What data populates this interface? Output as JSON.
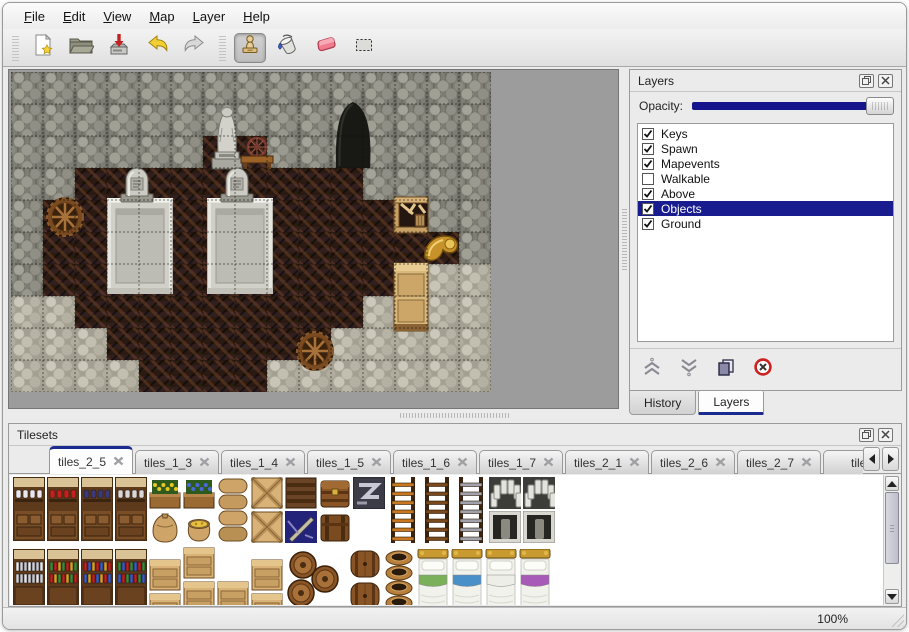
{
  "menu": {
    "items": [
      {
        "label": "File"
      },
      {
        "label": "Edit"
      },
      {
        "label": "View"
      },
      {
        "label": "Map"
      },
      {
        "label": "Layer"
      },
      {
        "label": "Help"
      }
    ]
  },
  "toolbar": {
    "groups": [
      {
        "buttons": [
          {
            "name": "new-file",
            "icon": "new-file-icon",
            "selected": false
          },
          {
            "name": "open",
            "icon": "open-icon",
            "selected": false
          },
          {
            "name": "save",
            "icon": "save-icon",
            "selected": false
          },
          {
            "name": "undo",
            "icon": "undo-icon",
            "selected": false
          },
          {
            "name": "redo",
            "icon": "redo-icon",
            "selected": false
          }
        ]
      },
      {
        "buttons": [
          {
            "name": "stamp-tool",
            "icon": "stamp-icon",
            "selected": true
          },
          {
            "name": "fill-tool",
            "icon": "fill-icon",
            "selected": false
          },
          {
            "name": "eraser-tool",
            "icon": "eraser-icon",
            "selected": false
          },
          {
            "name": "select-tool",
            "icon": "select-icon",
            "selected": false
          }
        ]
      }
    ]
  },
  "map": {
    "tile_size": 32,
    "grid": [
      "WWWWWWWWWWWWWWW",
      "WWWWWWWWWWWWWWW",
      "WWWWWWFFWWWWWWW",
      "WWFFFFFFFFFWWWW",
      "WFFFFFFFFFFFFWW",
      "WFFFFFFFFFFFFFW",
      "WFFFFFFFFFFFFSS",
      "SSFFFFFFFFFSFSS",
      "SSSFFFFFFFSSSSS",
      "SSSSFFFFSSSSSSS"
    ],
    "objects": [
      {
        "type": "cave-opening",
        "t": "cave",
        "x": 316,
        "y": 28
      },
      {
        "type": "statue",
        "t": "statue",
        "x": 194,
        "y": 28
      },
      {
        "type": "spinning-wheel-table",
        "t": "table",
        "x": 228,
        "y": 62
      },
      {
        "type": "stone-dais",
        "t": "dais",
        "x": 96,
        "y": 126
      },
      {
        "type": "stone-dais",
        "t": "dais",
        "x": 196,
        "y": 126
      },
      {
        "type": "gravestone",
        "t": "grave",
        "x": 106,
        "y": 92
      },
      {
        "type": "gravestone",
        "t": "grave",
        "x": 206,
        "y": 92
      },
      {
        "type": "barrel",
        "t": "barreltop",
        "x": 34,
        "y": 124
      },
      {
        "type": "barrel",
        "t": "barreltop",
        "x": 284,
        "y": 258
      },
      {
        "type": "broken-crate",
        "t": "cratebroken",
        "x": 382,
        "y": 124
      },
      {
        "type": "golden-horn",
        "t": "horn",
        "x": 408,
        "y": 156
      },
      {
        "type": "wooden-cabinet",
        "t": "cabinet",
        "x": 382,
        "y": 190
      }
    ]
  },
  "layers_panel": {
    "title": "Layers",
    "window_buttons": [
      {
        "icon": "restore-icon"
      },
      {
        "icon": "close-icon"
      }
    ],
    "opacity_label": "Opacity:",
    "opacity_percent": 100,
    "accent_color": "#16168c",
    "selection_color": "#181c8f",
    "layers": [
      {
        "label": "Keys",
        "checked": true,
        "selected": false
      },
      {
        "label": "Spawn",
        "checked": true,
        "selected": false
      },
      {
        "label": "Mapevents",
        "checked": true,
        "selected": false
      },
      {
        "label": "Walkable",
        "checked": false,
        "selected": false
      },
      {
        "label": "Above",
        "checked": true,
        "selected": false
      },
      {
        "label": "Objects",
        "checked": true,
        "selected": true
      },
      {
        "label": "Ground",
        "checked": true,
        "selected": false
      }
    ],
    "actions": [
      {
        "name": "move-layer-up",
        "icon": "chevrons-up-icon"
      },
      {
        "name": "move-layer-down",
        "icon": "chevrons-down-icon"
      },
      {
        "name": "duplicate-layer",
        "icon": "duplicate-icon"
      },
      {
        "name": "delete-layer",
        "icon": "delete-icon"
      }
    ],
    "tabs": [
      {
        "label": "History",
        "active": false
      },
      {
        "label": "Layers",
        "active": true
      }
    ]
  },
  "tilesets_panel": {
    "title": "Tilesets",
    "window_buttons": [
      {
        "icon": "restore-icon"
      },
      {
        "icon": "close-icon"
      }
    ],
    "tabs": [
      {
        "label": "tiles_2_5",
        "active": true,
        "closable": true
      },
      {
        "label": "tiles_1_3",
        "active": false,
        "closable": true
      },
      {
        "label": "tiles_1_4",
        "active": false,
        "closable": true
      },
      {
        "label": "tiles_1_5",
        "active": false,
        "closable": true
      },
      {
        "label": "tiles_1_6",
        "active": false,
        "closable": true
      },
      {
        "label": "tiles_1_7",
        "active": false,
        "closable": true
      },
      {
        "label": "tiles_2_1",
        "active": false,
        "closable": true
      },
      {
        "label": "tiles_2_6",
        "active": false,
        "closable": true
      },
      {
        "label": "tiles_2_7",
        "active": false,
        "closable": true
      },
      {
        "label": "tiles_",
        "active": false,
        "closable": false
      }
    ],
    "palette": [
      {
        "t": "shelf",
        "v": "dishes",
        "x": 1,
        "y": 0
      },
      {
        "t": "shelf",
        "v": "red",
        "x": 35,
        "y": 0
      },
      {
        "t": "shelf",
        "v": "pots",
        "x": 69,
        "y": 0
      },
      {
        "t": "shelf",
        "v": "jars",
        "x": 103,
        "y": 0
      },
      {
        "t": "plant",
        "v": "yellow",
        "x": 137,
        "y": 0
      },
      {
        "t": "plant",
        "v": "blue",
        "x": 171,
        "y": 0
      },
      {
        "t": "sackbig",
        "x": 137,
        "y": 34
      },
      {
        "t": "sackopen",
        "x": 171,
        "y": 34
      },
      {
        "t": "sackpile",
        "x": 205,
        "y": 0
      },
      {
        "t": "cratex",
        "x": 239,
        "y": 0
      },
      {
        "t": "cratex",
        "x": 239,
        "y": 34
      },
      {
        "t": "cratedark",
        "x": 273,
        "y": 0
      },
      {
        "t": "cratenavy",
        "x": 273,
        "y": 34
      },
      {
        "t": "chest",
        "x": 307,
        "y": 0
      },
      {
        "t": "chestband",
        "x": 307,
        "y": 34
      },
      {
        "t": "cratez",
        "x": 341,
        "y": 0
      },
      {
        "t": "ladder",
        "v": "#c87820",
        "x": 375,
        "y": 0
      },
      {
        "t": "ladder",
        "v": "#7a4a1c",
        "x": 409,
        "y": 0
      },
      {
        "t": "ladder",
        "v": "#a2a2ac",
        "x": 443,
        "y": 0
      },
      {
        "t": "archtop",
        "x": 477,
        "y": 0
      },
      {
        "t": "doorway",
        "x": 477,
        "y": 34
      },
      {
        "t": "archtop",
        "x": 511,
        "y": 0
      },
      {
        "t": "doorway",
        "x": 511,
        "y": 34
      },
      {
        "t": "shelfbooks",
        "v": "white",
        "x": 1,
        "y": 72
      },
      {
        "t": "shelfbooks",
        "v": "green",
        "x": 35,
        "y": 72
      },
      {
        "t": "shelfbooks",
        "v": "red",
        "x": 69,
        "y": 72
      },
      {
        "t": "shelfbooks",
        "v": "multi",
        "x": 103,
        "y": 72
      },
      {
        "t": "crate",
        "x": 137,
        "y": 82
      },
      {
        "t": "crate",
        "x": 137,
        "y": 116
      },
      {
        "t": "crate",
        "x": 171,
        "y": 70
      },
      {
        "t": "crate",
        "x": 171,
        "y": 104
      },
      {
        "t": "crate",
        "x": 205,
        "y": 104
      },
      {
        "t": "crate",
        "x": 239,
        "y": 82
      },
      {
        "t": "crate",
        "x": 239,
        "y": 116
      },
      {
        "t": "barrelcluster",
        "x": 271,
        "y": 74
      },
      {
        "t": "barrel",
        "x": 337,
        "y": 72
      },
      {
        "t": "barrel",
        "x": 337,
        "y": 104
      },
      {
        "t": "potstack",
        "x": 371,
        "y": 72
      },
      {
        "t": "bed",
        "v": "#7ab05a",
        "x": 405,
        "y": 72
      },
      {
        "t": "bed",
        "v": "#4a90c8",
        "x": 439,
        "y": 72
      },
      {
        "t": "bed",
        "v": "#eeeee8",
        "x": 473,
        "y": 72
      },
      {
        "t": "bed",
        "v": "#a85ab8",
        "x": 507,
        "y": 72
      }
    ]
  },
  "status": {
    "zoom": "100%"
  }
}
